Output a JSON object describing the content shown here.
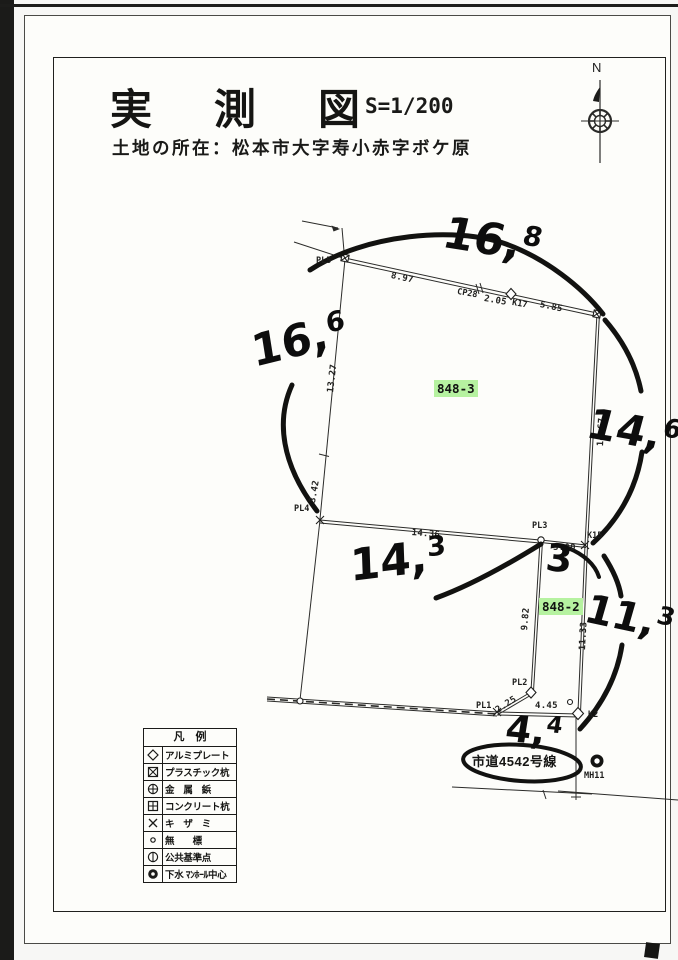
{
  "doc": {
    "title": "実測図",
    "scale": "S=1/200",
    "location": "土地の所在：松本市大字寿小赤字ボケ原",
    "north": "N"
  },
  "parcels": {
    "main": "848-3",
    "sub": "848-2"
  },
  "road": {
    "name": "市道4542号線"
  },
  "points": {
    "pl5": "PL5",
    "cp28": "CP28",
    "k17": "K17",
    "k15": "K15",
    "pl4": "PL4",
    "pl3": "PL3",
    "pl2": "PL2",
    "pl1": "PL1",
    "k2": "K2",
    "mh11": "MH11"
  },
  "measurements": {
    "pl5_cp28": "8.97",
    "cp28_k17": "2.05",
    "k17_tr": "5.85",
    "left_upper": "13.27",
    "left_lower": "3.42",
    "pl4_pl3": "14.36",
    "pl3_k15": "3.00",
    "tr_k15": "14.67",
    "k15_k2": "11.33",
    "pl3_pl2": "9.82",
    "pl2_pl1": "2.25",
    "pl1_k2": "4.45"
  },
  "handwritten": {
    "top": {
      "main": "16,",
      "sup": "8"
    },
    "left": {
      "main": "16,",
      "sup": "6"
    },
    "right_upper": {
      "main": "14,",
      "sup": "6"
    },
    "middle": {
      "main": "14,",
      "sup": "3"
    },
    "three": {
      "main": "3",
      "sup": ""
    },
    "right_lower": {
      "main": "11,",
      "sup": "3"
    },
    "bottom": {
      "main": "4,",
      "sup": "4"
    }
  },
  "legend": {
    "title": "凡　例",
    "items": [
      {
        "symbol": "diamond-outline-icon",
        "label": "アルミプレート"
      },
      {
        "symbol": "square-x-icon",
        "label": "プラスチック杭"
      },
      {
        "symbol": "circle-cross-icon",
        "label": "金　属　鋲"
      },
      {
        "symbol": "square-cross-icon",
        "label": "コンクリート杭"
      },
      {
        "symbol": "x-mark-icon",
        "label": "キ　ザ　ミ"
      },
      {
        "symbol": "small-circle-icon",
        "label": "無　　標"
      },
      {
        "symbol": "circle-bar-icon",
        "label": "公共基準点"
      },
      {
        "symbol": "filled-circle-dot-icon",
        "label": "下水 ﾏﾝﾎｰﾙ中心"
      }
    ]
  },
  "colors": {
    "highlight": "#b6f2a0",
    "ink": "#1c1c1c"
  }
}
